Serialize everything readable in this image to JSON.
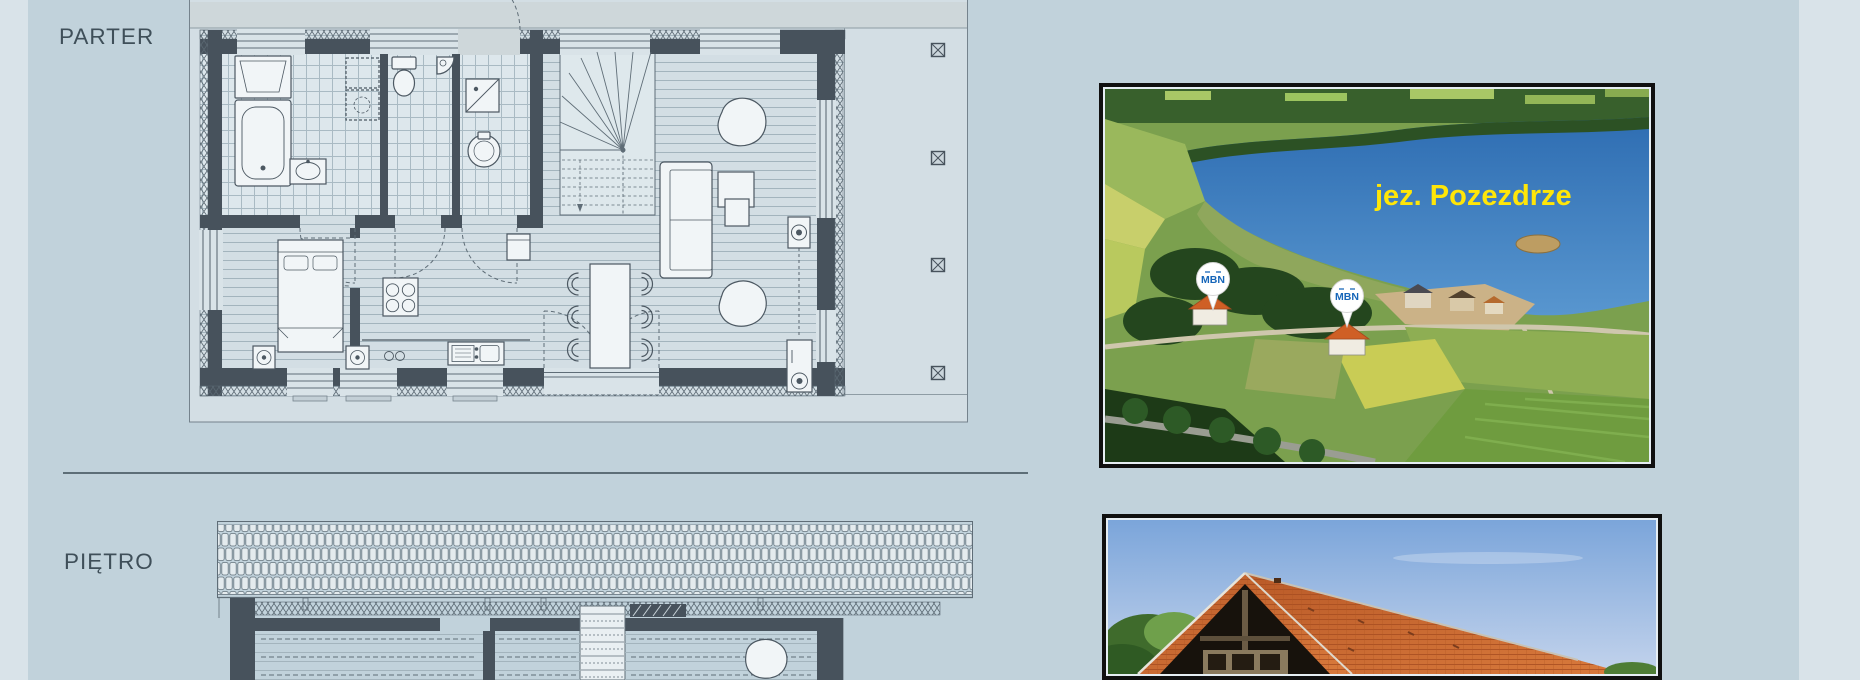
{
  "page": {
    "background": "#c1d2db",
    "margin_color": "#d9e3e9"
  },
  "labels": {
    "parter": "PARTER",
    "pietro": "PIĘTRO"
  },
  "lake_photo": {
    "caption": "jez. Pozezdrze",
    "caption_color": "#ffe608",
    "pins": [
      {
        "label": "MBN"
      },
      {
        "label": "MBN"
      }
    ],
    "pin_text_color": "#1565b8"
  },
  "colors": {
    "plan_wall": "#47525c",
    "plan_line": "#5f6d77",
    "separator": "#5d6e77",
    "label_text": "#3f4f59",
    "photo_border": "#101010",
    "roof_orange": "#c8602b",
    "lake_blue": "#2e6db2"
  }
}
